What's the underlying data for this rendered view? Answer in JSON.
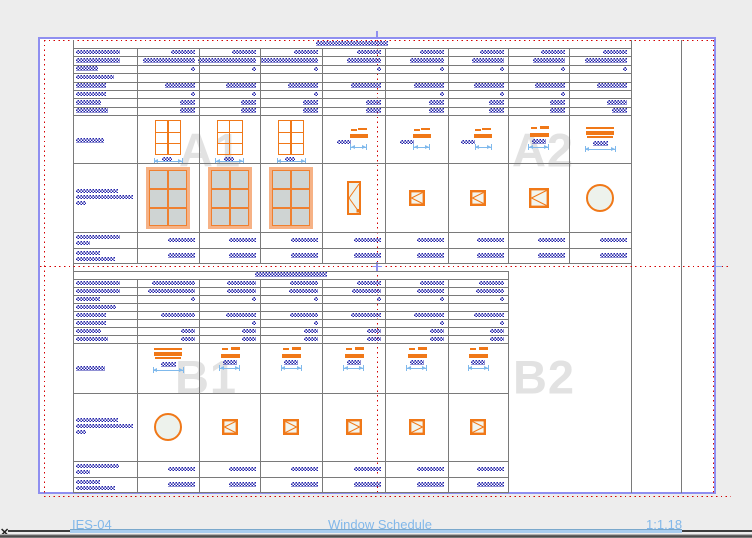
{
  "app": {
    "statusbar": {
      "sheet_number": "IES-04",
      "sheet_title": "Window Schedule",
      "scale": "1:1.18"
    },
    "scrollbar": {
      "close_glyph": "✕",
      "thumb_x": 70,
      "thumb_w": 612
    }
  },
  "colors": {
    "canvas": "#ededed",
    "sheet": "#ffffff",
    "border": "#8f8ff0",
    "reddot": "#d40000",
    "grid": "#7a7a7a",
    "hatch": "#2323aa",
    "orange": "#f07818",
    "salmon": "#f6b286",
    "glass": "#cfd4d3",
    "pale": "#edf2ec",
    "dim": "#7fb9ec",
    "watermark": "#e2e2e2",
    "status_text": "#82b8ea",
    "thumb": "#a9cdf0",
    "track": "#3d3d3d"
  },
  "drawing": {
    "sheet_rect": {
      "x": 38,
      "y": 37,
      "w": 678,
      "h": 457
    },
    "margin": {
      "x1": 44,
      "y1": 40,
      "x2": 713,
      "y2": 494,
      "bottom_y": 495.5,
      "right_ext": 731
    },
    "frame_verticals": [
      73,
      631,
      681
    ],
    "quadrant": {
      "vx": 376.5,
      "hy": 265.5,
      "top_tick_y": 31,
      "right_dash_x": 714
    },
    "watermarks": [
      {
        "label": "A1",
        "cx": 210,
        "cy": 150
      },
      {
        "label": "A2",
        "cx": 543,
        "cy": 150
      },
      {
        "label": "B1",
        "cx": 206,
        "cy": 377
      },
      {
        "label": "B2",
        "cx": 544,
        "cy": 377
      }
    ],
    "tables": [
      {
        "name": "schedule-a",
        "cols": [
          73,
          137,
          199,
          260,
          322,
          385,
          448,
          508,
          569,
          631
        ],
        "title": {
          "cx": 352,
          "y": 40.5,
          "w": 72
        },
        "header_top": 48,
        "row_h": 8.375,
        "header_rows": [
          {
            "label": 44,
            "vals": [
              24,
              24,
              24,
              24,
              24,
              24,
              24,
              24
            ]
          },
          {
            "label": 44,
            "vals": [
              52,
              58,
              58,
              34,
              34,
              32,
              32,
              42
            ]
          },
          {
            "label": 22,
            "ticks": [
              0,
              1,
              2,
              3,
              4,
              5,
              6,
              7
            ]
          },
          {
            "label": 38
          },
          {
            "label": 30,
            "vals": [
              30,
              30,
              30,
              30,
              30,
              30,
              30,
              30
            ]
          },
          {
            "label": 30,
            "ticks": [
              0,
              1,
              2,
              4,
              5,
              6
            ]
          },
          {
            "label": 25,
            "vals": [
              15,
              15,
              15,
              15,
              15,
              15,
              15,
              20
            ]
          },
          {
            "label": 32,
            "vals": [
              15,
              15,
              15,
              15,
              15,
              15,
              15,
              15
            ]
          }
        ],
        "elev": {
          "top": 115,
          "bot": 163,
          "cy": 139,
          "ly": 138,
          "label": [
            28
          ],
          "items": [
            "win",
            "win",
            "win",
            "da",
            "da",
            "da",
            "db",
            "dw"
          ]
        },
        "render": {
          "top": 163,
          "bot": 232,
          "cy": 197.5,
          "ly": 188.5,
          "label": [
            42,
            57,
            10
          ],
          "items": [
            "bigwin",
            "bigwin",
            "bigwin",
            "tall",
            "sqL",
            "sqL",
            "sqM",
            "circ"
          ]
        },
        "footers": [
          {
            "top": 232,
            "bot": 248,
            "label": [
              44,
              14
            ],
            "val": 27
          },
          {
            "top": 248,
            "bot": 263,
            "label": [
              24,
              39
            ],
            "val": 27
          }
        ]
      },
      {
        "name": "schedule-b",
        "cols": [
          73,
          137,
          199,
          260,
          322,
          385,
          448,
          508
        ],
        "box_top": 271,
        "title": {
          "cx": 290.5,
          "y": 272,
          "w": 72
        },
        "header_top": 279,
        "row_h": 8,
        "header_rows": [
          {
            "label": 44,
            "vals": [
              43,
              29,
              28,
              24,
              24,
              25
            ]
          },
          {
            "label": 44,
            "vals": [
              47,
              29,
              29,
              29,
              27,
              28
            ]
          },
          {
            "label": 24,
            "ticks": [
              0,
              1,
              2,
              3,
              4,
              5
            ]
          },
          {
            "label": 40
          },
          {
            "label": 30,
            "vals": [
              34,
              30,
              28,
              30,
              30,
              30
            ]
          },
          {
            "label": 30,
            "ticks": [
              1,
              2,
              4,
              5
            ]
          },
          {
            "label": 25,
            "vals": [
              14,
              14,
              14,
              14,
              14,
              14
            ]
          },
          {
            "label": 32,
            "vals": [
              14,
              14,
              14,
              14,
              14,
              14
            ]
          }
        ],
        "elev": {
          "top": 343,
          "bot": 393,
          "cy": 360,
          "ly": 366,
          "label": [
            29
          ],
          "items": [
            "dw",
            "db",
            "db",
            "db",
            "db",
            "db"
          ]
        },
        "render": {
          "top": 393,
          "bot": 461,
          "cy": 427,
          "ly": 417.5,
          "label": [
            42,
            57,
            10
          ],
          "items": [
            "circ",
            "sqL",
            "sqR",
            "sqR",
            "sqR",
            "sqR"
          ]
        },
        "footers": [
          {
            "top": 461,
            "bot": 477,
            "label": [
              43,
              14
            ],
            "val": 27
          },
          {
            "top": 477,
            "bot": 492,
            "label": [
              24,
              39
            ],
            "val": 27
          }
        ]
      }
    ]
  }
}
